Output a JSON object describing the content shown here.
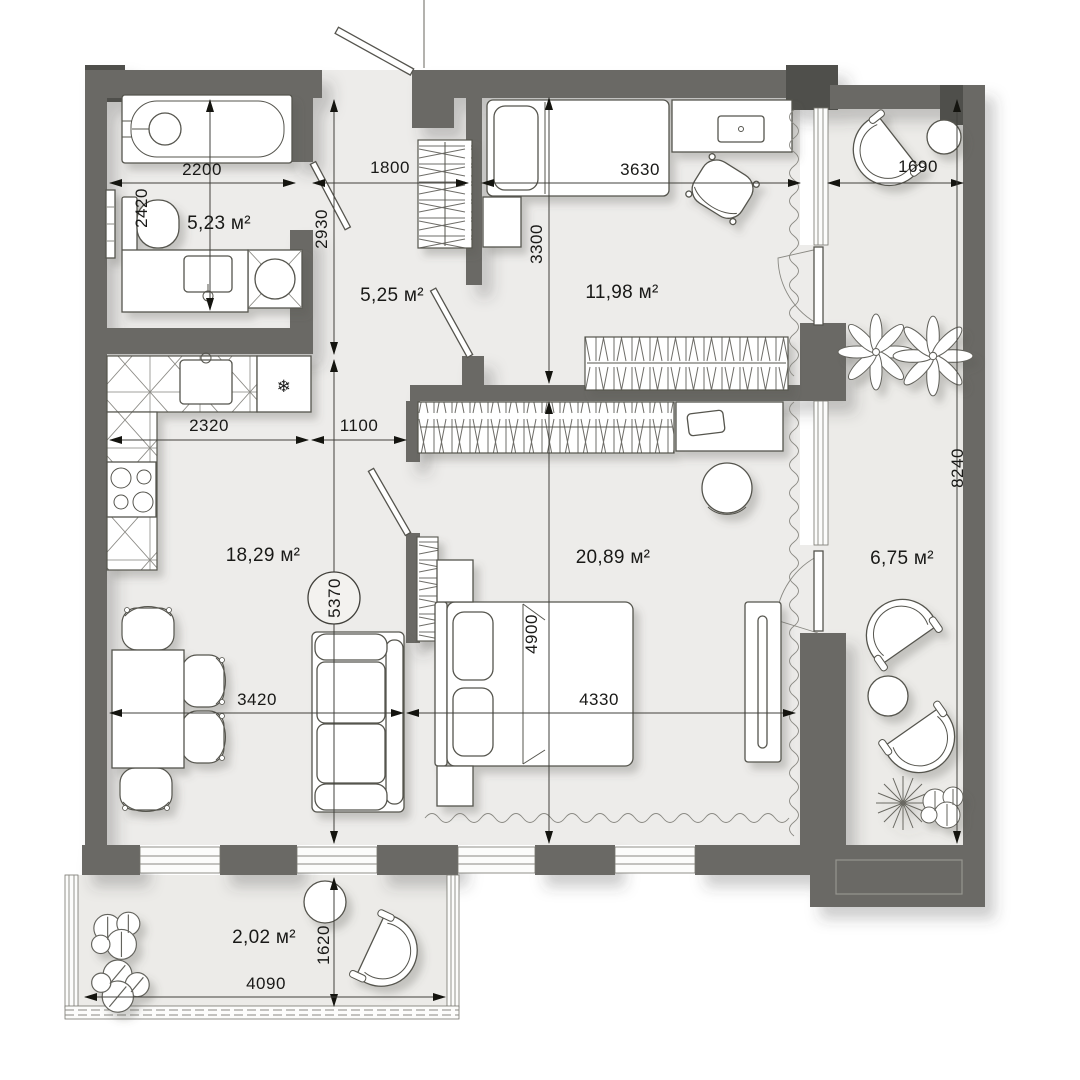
{
  "plan_title": "apartment floor plan",
  "units": "mm",
  "area_unit": "м²",
  "rooms": [
    {
      "name": "bathroom",
      "area": "5,23 м²"
    },
    {
      "name": "hallway",
      "area": "5,25 м²"
    },
    {
      "name": "bedroom-small",
      "area": "11,98 м²"
    },
    {
      "name": "kitchen-living-room",
      "area": "18,29 м²"
    },
    {
      "name": "bedroom-master",
      "area": "20,89 м²"
    },
    {
      "name": "loggia-right",
      "area": "6,75 м²"
    },
    {
      "name": "balcony-bottom",
      "area": "2,02 м²"
    }
  ],
  "dimensions": [
    {
      "name": "bathroom-width",
      "value": "2200"
    },
    {
      "name": "hallway-width",
      "value": "1800"
    },
    {
      "name": "bedroom-small-width",
      "value": "3630"
    },
    {
      "name": "loggia-width",
      "value": "1690"
    },
    {
      "name": "bathroom-depth",
      "value": "2420"
    },
    {
      "name": "hallway-depth",
      "value": "2930"
    },
    {
      "name": "bedroom-small-depth",
      "value": "3300"
    },
    {
      "name": "loggia-length",
      "value": "8240"
    },
    {
      "name": "kitchen-run",
      "value": "2320"
    },
    {
      "name": "passage-width",
      "value": "1100"
    },
    {
      "name": "living-room-depth",
      "value": "5370"
    },
    {
      "name": "bedroom-master-depth",
      "value": "4900"
    },
    {
      "name": "living-room-width",
      "value": "3420"
    },
    {
      "name": "bedroom-master-width",
      "value": "4330"
    },
    {
      "name": "balcony-depth",
      "value": "1620"
    },
    {
      "name": "balcony-width",
      "value": "4090"
    }
  ],
  "symbols": {
    "fridge": "❄"
  },
  "colors": {
    "wall": "#6a6965",
    "wall_accent": "#504f4b",
    "floor": "#edecea",
    "outline": "#55544e",
    "dimension_text": "#191917",
    "background": "#ffffff"
  }
}
